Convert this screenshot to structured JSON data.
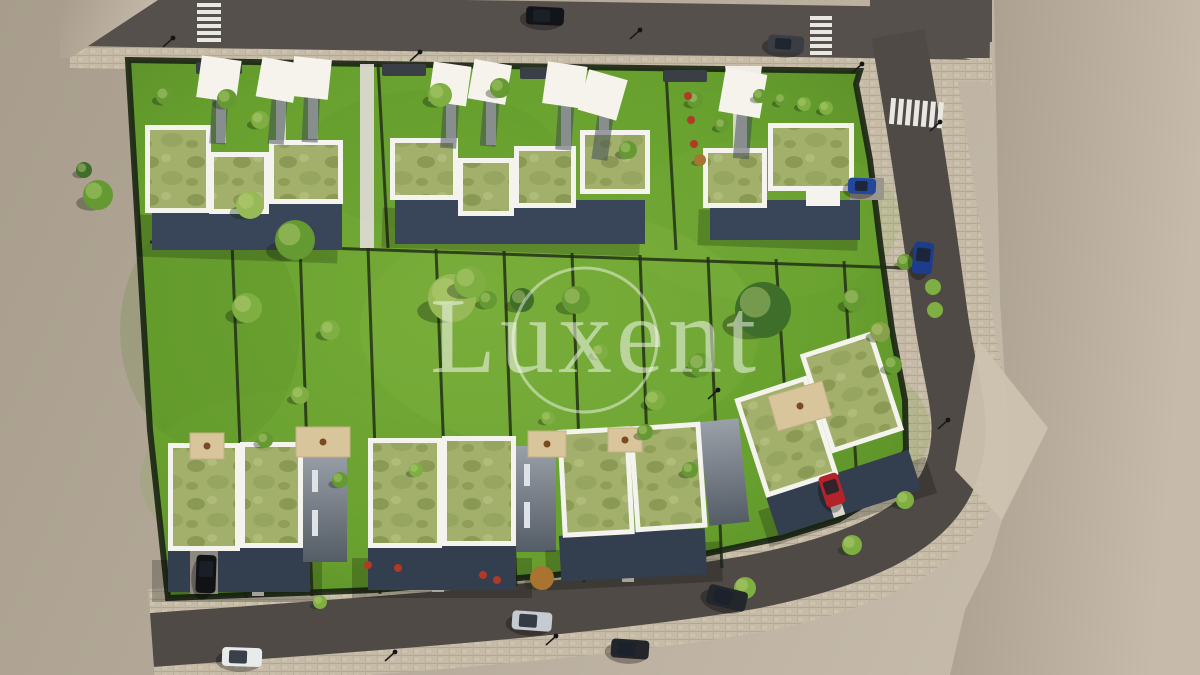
{
  "watermark": {
    "text": "Luxent"
  },
  "palette": {
    "ground": "#b3a897",
    "ground_light": "#c6bbaa",
    "road": "#55504b",
    "road_dark": "#4a4540",
    "paver": "#c6bba6",
    "paver_line": "#b2a791",
    "grass": "#67a02e",
    "grass_light": "#8dbb4a",
    "grass_dark": "#4f7d23",
    "hedge": "#1d2a14",
    "roof_grass": "#a2b06c",
    "roof_blotch": "#8a9a54",
    "parapet": "#f4f3ee",
    "wall": "#39465a",
    "wall_light": "#9aa0a8",
    "sail": "#f5f3ec",
    "walkway": "#dcd9d1",
    "deck": "#d8c59b",
    "watermark_white": "#ffffff"
  },
  "scene": {
    "description": "Top-down aerial 3D architectural render of a residential development: two rows of flat green-roof houses with white parapets, private hedged gardens, white shade sails, surrounding asphalt streets with paver sidewalks, crosswalks and parked cars, on bare beige ground",
    "tree_colors": [
      "#4d7a28",
      "#659a33",
      "#7fae43",
      "#97b958",
      "#3f6e2a",
      "#86a04b"
    ],
    "trees": [
      [
        98,
        195,
        15,
        1
      ],
      [
        84,
        170,
        8,
        4
      ],
      [
        165,
        96,
        9,
        1
      ],
      [
        227,
        99,
        10,
        1
      ],
      [
        260,
        120,
        9,
        2
      ],
      [
        250,
        205,
        14,
        3
      ],
      [
        295,
        240,
        20,
        1
      ],
      [
        247,
        308,
        15,
        2
      ],
      [
        330,
        330,
        10,
        2
      ],
      [
        300,
        395,
        9,
        2
      ],
      [
        265,
        440,
        8,
        1
      ],
      [
        440,
        95,
        12,
        2
      ],
      [
        500,
        88,
        10,
        1
      ],
      [
        452,
        298,
        24,
        3
      ],
      [
        470,
        282,
        16,
        2
      ],
      [
        522,
        300,
        12,
        4
      ],
      [
        576,
        300,
        14,
        1
      ],
      [
        600,
        352,
        8,
        2
      ],
      [
        763,
        310,
        28,
        4
      ],
      [
        700,
        365,
        12,
        1
      ],
      [
        655,
        400,
        10,
        2
      ],
      [
        645,
        432,
        8,
        1
      ],
      [
        855,
        300,
        12,
        1
      ],
      [
        880,
        332,
        10,
        5
      ],
      [
        893,
        365,
        9,
        1
      ],
      [
        905,
        262,
        8,
        1
      ],
      [
        628,
        150,
        9,
        1
      ],
      [
        760,
        96,
        7,
        1
      ],
      [
        782,
        100,
        7,
        1
      ],
      [
        804,
        104,
        7,
        2
      ],
      [
        826,
        108,
        7,
        2
      ],
      [
        695,
        100,
        8,
        1
      ],
      [
        722,
        125,
        7,
        1
      ],
      [
        340,
        480,
        8,
        1
      ],
      [
        416,
        470,
        7,
        2
      ],
      [
        320,
        602,
        7,
        2
      ],
      [
        745,
        588,
        11,
        2
      ],
      [
        852,
        545,
        10,
        2
      ],
      [
        905,
        500,
        9,
        2
      ],
      [
        488,
        300,
        9,
        1
      ],
      [
        548,
        418,
        7,
        2
      ],
      [
        690,
        470,
        8,
        1
      ]
    ],
    "autumn_trees": [
      [
        542,
        578,
        12
      ],
      [
        700,
        160,
        6
      ]
    ],
    "shrubs_red": [
      [
        688,
        96
      ],
      [
        691,
        120
      ],
      [
        694,
        144
      ],
      [
        483,
        575
      ],
      [
        497,
        580
      ],
      [
        368,
        565
      ],
      [
        398,
        568
      ]
    ],
    "planter_trees": [
      [
        933,
        287
      ],
      [
        935,
        310
      ]
    ],
    "sails": [
      [
        219,
        78,
        40,
        8
      ],
      [
        278,
        79,
        38,
        10
      ],
      [
        311,
        77,
        38,
        6
      ],
      [
        450,
        83,
        38,
        8
      ],
      [
        490,
        81,
        38,
        10
      ],
      [
        565,
        84,
        40,
        8
      ],
      [
        603,
        94,
        40,
        16
      ],
      [
        743,
        92,
        42,
        10
      ]
    ],
    "decks": [
      [
        190,
        433,
        34,
        26,
        0
      ],
      [
        296,
        427,
        54,
        30,
        0
      ],
      [
        528,
        431,
        38,
        26,
        0
      ],
      [
        608,
        428,
        34,
        24,
        0
      ],
      [
        772,
        388,
        56,
        36,
        -16
      ]
    ],
    "hedge_lines": [
      [
        378,
        64,
        388,
        248
      ],
      [
        666,
        72,
        676,
        250
      ],
      [
        150,
        242,
        905,
        268
      ],
      [
        232,
        243,
        246,
        598
      ],
      [
        300,
        245,
        312,
        596
      ],
      [
        368,
        247,
        380,
        594
      ],
      [
        436,
        249,
        448,
        560
      ],
      [
        504,
        251,
        516,
        586
      ],
      [
        572,
        253,
        584,
        582
      ],
      [
        640,
        255,
        652,
        576
      ],
      [
        708,
        257,
        722,
        568
      ],
      [
        776,
        259,
        790,
        470
      ],
      [
        844,
        261,
        858,
        500
      ]
    ],
    "walkways": [
      [
        216,
        95,
        10,
        48
      ],
      [
        276,
        95,
        10,
        50
      ],
      [
        308,
        93,
        10,
        46
      ],
      [
        446,
        95,
        10,
        50
      ],
      [
        486,
        95,
        10,
        50
      ],
      [
        561,
        98,
        10,
        48
      ],
      [
        599,
        108,
        10,
        44
      ],
      [
        733,
        100,
        14,
        52
      ],
      [
        252,
        552,
        12,
        44
      ],
      [
        432,
        550,
        12,
        42
      ],
      [
        622,
        538,
        12,
        44
      ],
      [
        360,
        64,
        14,
        184
      ]
    ],
    "cars": [
      [
        545,
        16,
        38,
        18,
        3,
        "#121418"
      ],
      [
        786,
        44,
        36,
        17,
        4,
        "#3a3e44"
      ],
      [
        923,
        258,
        20,
        32,
        6,
        "#1d3d8c"
      ],
      [
        862,
        186,
        28,
        16,
        2,
        "#24479c"
      ],
      [
        727,
        598,
        40,
        20,
        14,
        "#23262b"
      ],
      [
        532,
        621,
        40,
        19,
        4,
        "#c6cad1"
      ],
      [
        630,
        649,
        38,
        19,
        4,
        "#222529"
      ],
      [
        242,
        657,
        40,
        19,
        2,
        "#e9eaec"
      ],
      [
        206,
        574,
        20,
        38,
        2,
        "#101214"
      ],
      [
        832,
        490,
        20,
        32,
        -18,
        "#b4232a"
      ]
    ],
    "lamps": [
      [
        173,
        38
      ],
      [
        420,
        52
      ],
      [
        640,
        30
      ],
      [
        940,
        122
      ],
      [
        948,
        420
      ],
      [
        718,
        390
      ],
      [
        556,
        636
      ],
      [
        395,
        652
      ],
      [
        862,
        64
      ]
    ]
  }
}
